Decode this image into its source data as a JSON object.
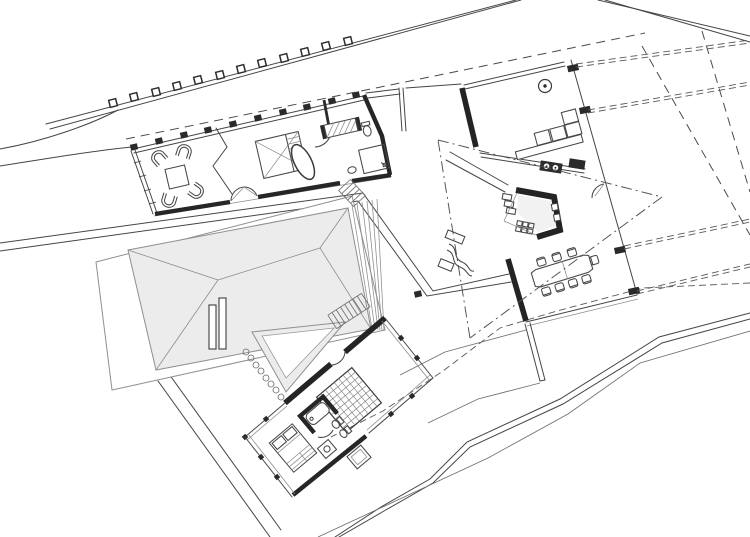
{
  "document": {
    "kind": "architectural-floor-plan",
    "description_label": "Site floor plan with three rotated building wings, pergola colonnade, hip roof courtyard and terrain contours"
  },
  "palette": {
    "background": "#ffffff",
    "line": "#454545",
    "light_line": "#8a8a8a",
    "wall": "#262626",
    "roof_fill": "#ececec",
    "roof_shadow": "#dedede",
    "roof_stroke": "#8f8f8f",
    "inset_fill": "#f4f4f4",
    "floor_fill": "#f2f2f2",
    "white": "#ffffff"
  },
  "inventory": {
    "pergola_columns": 12,
    "wing_columns": 10,
    "lounge_chairs": 4,
    "dining_chairs": 8,
    "roof_chimneys": 2,
    "right_wall_columns": 4,
    "stone_path_discs": 8
  }
}
